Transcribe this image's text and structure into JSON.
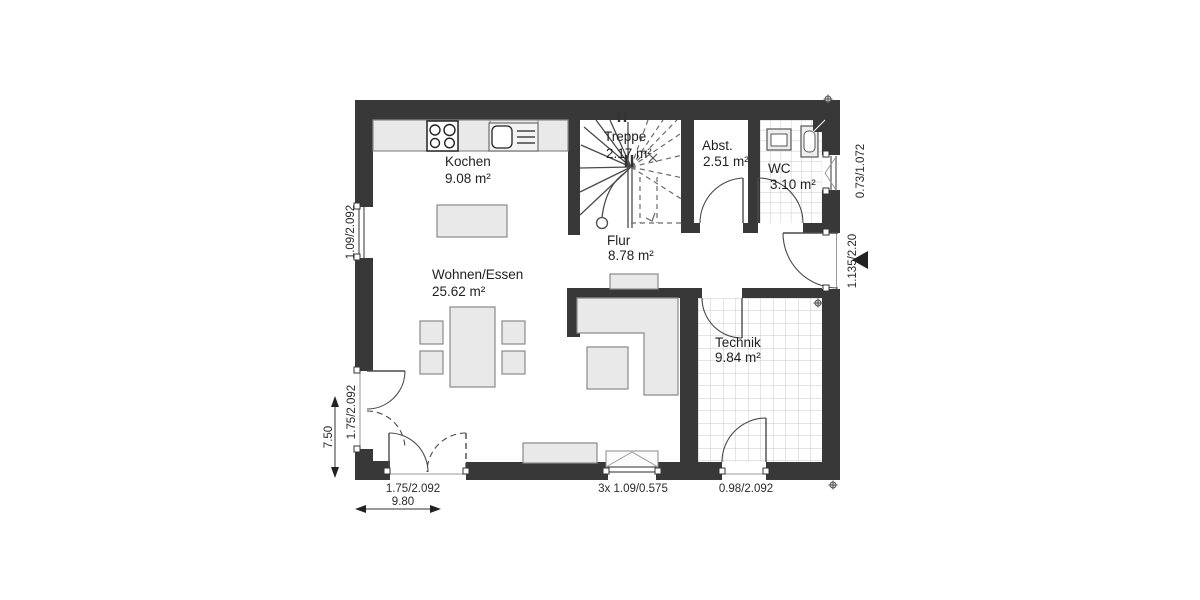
{
  "plan_type": "floor-plan",
  "rooms": {
    "kochen": {
      "name": "Kochen",
      "area": "9.08 m²"
    },
    "treppe": {
      "name": "Treppe",
      "area": "2.17 m²"
    },
    "abst": {
      "name": "Abst.",
      "area": "2.51 m²"
    },
    "wc": {
      "name": "WC",
      "area": "3.10 m²"
    },
    "flur": {
      "name": "Flur",
      "area": "8.78 m²"
    },
    "wohnen": {
      "name": "Wohnen/Essen",
      "area": "25.62 m²"
    },
    "technik": {
      "name": "Technik",
      "area": "9.84 m²"
    }
  },
  "dimensions": {
    "left_window": "1.09/2.092",
    "left_door": "1.75/2.092",
    "left_total": "7.50",
    "bottom_door": "1.75/2.092",
    "bottom_total": "9.80",
    "bottom_window": "3x 1.09/0.575",
    "technik_door": "0.98/2.092",
    "wc_window": "0.73/1.072",
    "entrance_door": "1.135/2.20"
  },
  "colors": {
    "wall": "#383838",
    "furniture_fill": "#e9e9e9",
    "tile_line": "#c8c8c8",
    "background": "#ffffff"
  }
}
